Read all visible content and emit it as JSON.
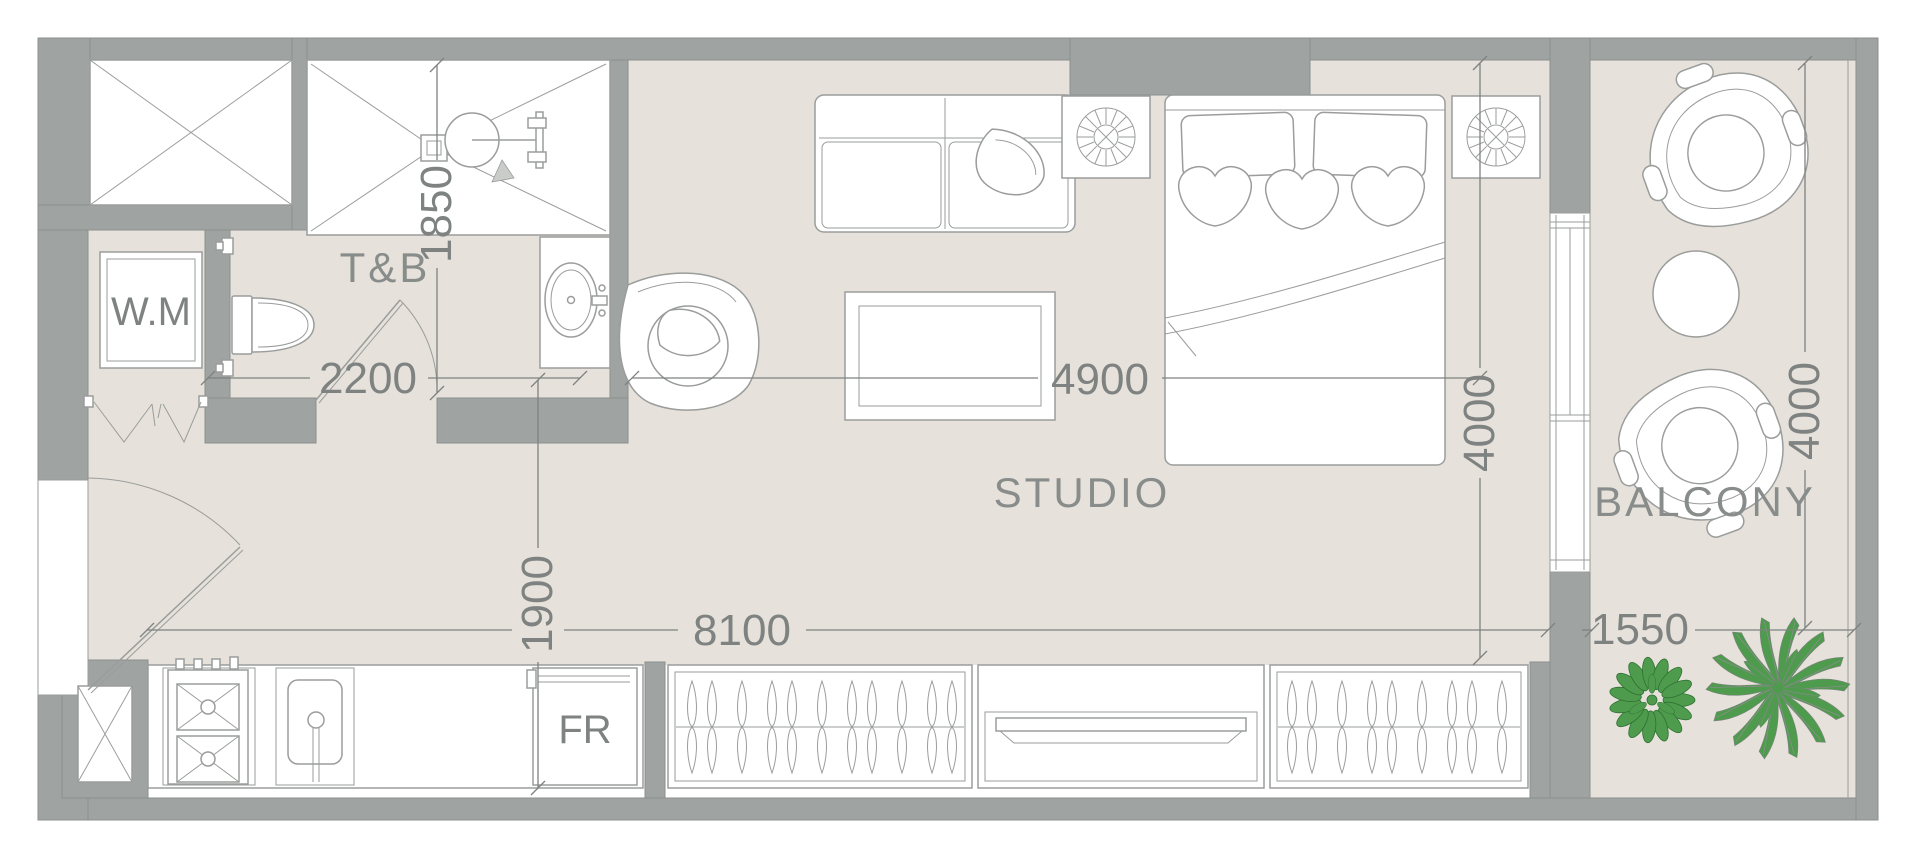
{
  "plan_labels": {
    "toilet_bath": "T&B",
    "studio": "STUDIO",
    "balcony": "BALCONY",
    "washing_machine": "W.M",
    "fridge": "FR"
  },
  "dimensions_mm": {
    "tb_depth": "1850",
    "tb_width": "2200",
    "living_width": "4900",
    "studio_depth": "4000",
    "entry_width": "1900",
    "unit_length": "8100",
    "balcony_width": "1550",
    "balcony_depth": "4000"
  },
  "colors": {
    "wall": "#9fa3a1",
    "wallDark": "#8b8f8d",
    "floor": "#e6e1da",
    "line": "#9a9d9b",
    "dimText": "#7e8281",
    "labelText": "#888c8a",
    "green": "#4e9b4e",
    "greenDark": "#2f7032"
  }
}
